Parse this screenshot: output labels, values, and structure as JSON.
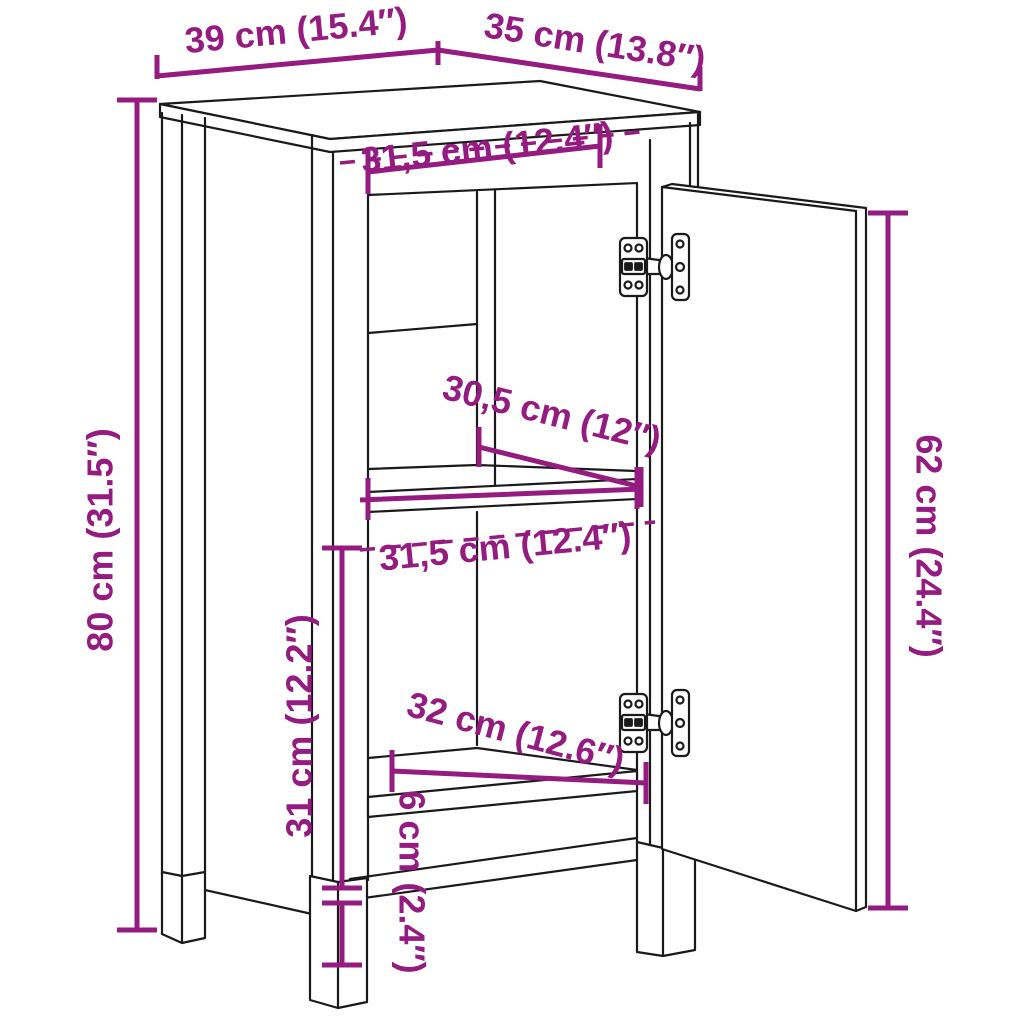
{
  "figure": {
    "subject": "cabinet with two open compartments and an open right-hand door shown with concealed hinges",
    "style": "black outline technical drawing with purple dimension annotations",
    "background_color": "#ffffff",
    "line_color": "#1a1a1a",
    "dimension_color": "#941b80"
  },
  "diagram": {
    "dimensions": [
      {
        "id": "width-top",
        "cm": 39,
        "inches": 15.4,
        "label": "39 cm (15.4″)"
      },
      {
        "id": "depth-top",
        "cm": 35,
        "inches": 13.8,
        "label": "35 cm (13.8″)"
      },
      {
        "id": "inner-width-top",
        "cm": 31.5,
        "inches": 12.4,
        "label": "31,5 cm (12.4″)"
      },
      {
        "id": "height-left",
        "cm": 80,
        "inches": 31.5,
        "label": "80 cm (31.5″)"
      },
      {
        "id": "shelf-depth",
        "cm": 30.5,
        "inches": 12,
        "label": "30,5 cm (12″)"
      },
      {
        "id": "inner-width-middle",
        "cm": 31.5,
        "inches": 12.4,
        "label": "31,5 cm (12.4″)"
      },
      {
        "id": "inner-height-lower",
        "cm": 31,
        "inches": 12.2,
        "label": "31 cm (12.2″)"
      },
      {
        "id": "inner-width-lower",
        "cm": 32,
        "inches": 12.6,
        "label": "32 cm (12.6″)"
      },
      {
        "id": "plinth-height",
        "cm": 6,
        "inches": 2.4,
        "label": "6 cm (2.4″)"
      },
      {
        "id": "door-height",
        "cm": 62,
        "inches": 24.4,
        "label": "62 cm (24.4″)"
      }
    ]
  }
}
